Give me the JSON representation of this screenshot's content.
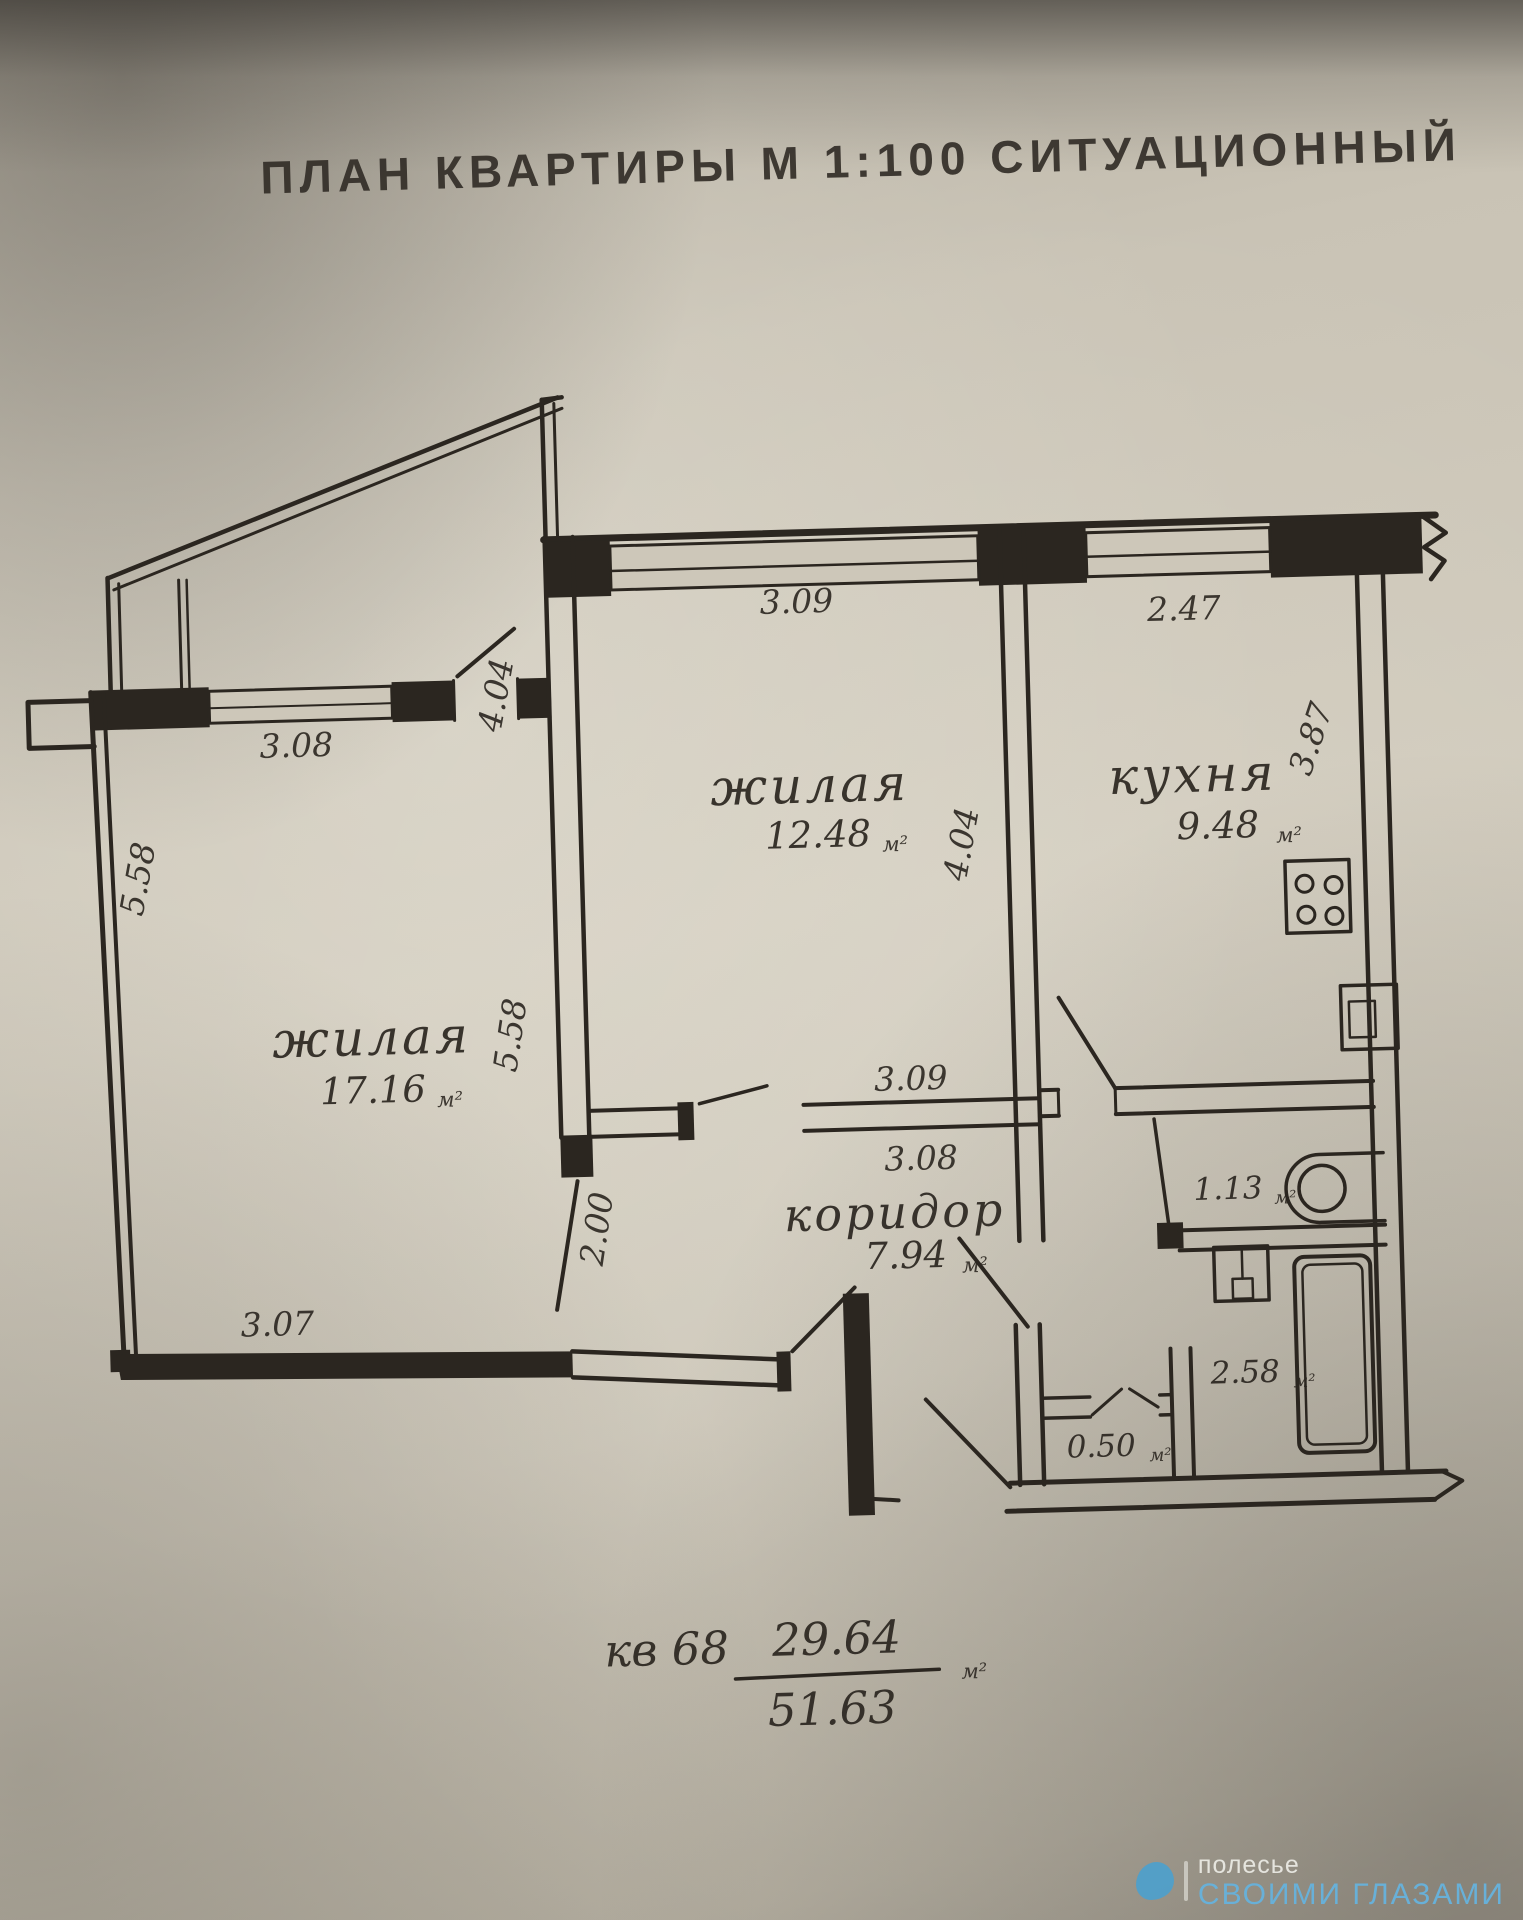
{
  "title": "ПЛАН  КВАРТИРЫ М 1:100  СИТУАЦИОННЫЙ",
  "rooms": {
    "living1": {
      "name": "жилая",
      "area": "17.16",
      "unit": "м²"
    },
    "living2": {
      "name": "жилая",
      "area": "12.48",
      "unit": "м²"
    },
    "kitchen": {
      "name": "кухня",
      "area": "9.48",
      "unit": "м²"
    },
    "corridor": {
      "name": "коридор",
      "area": "7.94",
      "unit": "м²"
    },
    "wc": {
      "area": "1.13",
      "unit": "м²"
    },
    "bath": {
      "area": "2.58",
      "unit": "м²"
    },
    "closet": {
      "area": "0.50",
      "unit": "м²"
    }
  },
  "dimensions": {
    "top_window_mid": "3.09",
    "top_window_kitchen": "2.47",
    "left_room_window": "3.08",
    "mid_room_left_height": "4.04",
    "mid_room_right_height": "4.04",
    "kitchen_height": "3.87",
    "left_room_outer_height": "5.58",
    "left_room_inner_height": "5.58",
    "corridor_left_height": "2.00",
    "corridor_top_a": "3.09",
    "corridor_top_b": "3.08",
    "left_room_bottom": "3.07"
  },
  "summary": {
    "apartment": "кв 68",
    "living_area": "29.64",
    "total_area": "51.63",
    "unit": "м²"
  },
  "watermark": {
    "brand": "полесье",
    "tagline": "своими глазами"
  }
}
